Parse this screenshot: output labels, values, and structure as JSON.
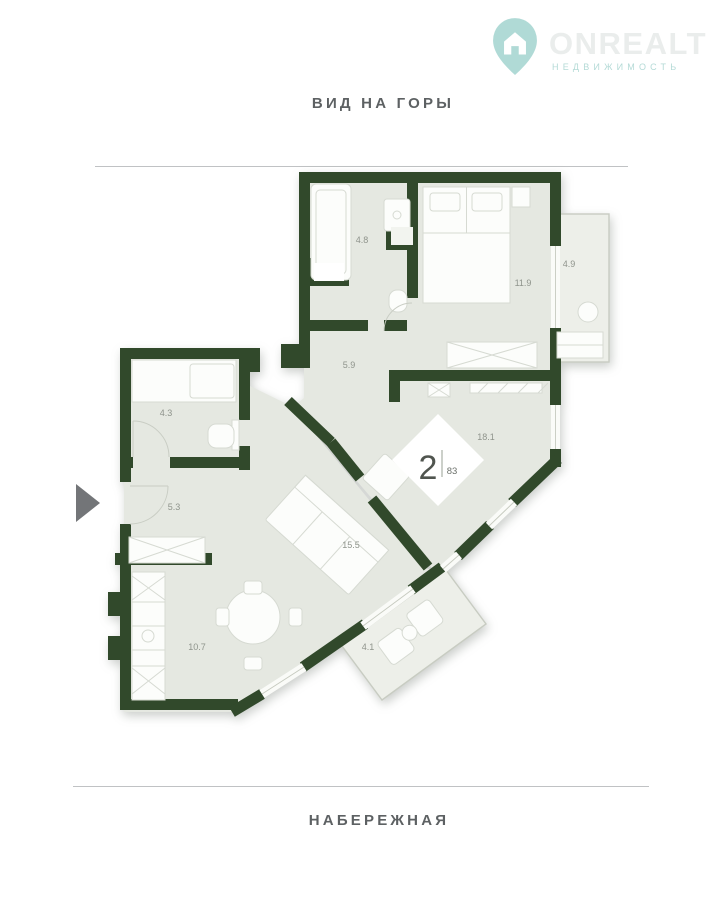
{
  "watermark": {
    "brand": "ONREALT",
    "tagline": "НЕДВИЖИМОСТЬ"
  },
  "orientation": {
    "top": "ВИД НА ГОРЫ",
    "bottom": "НАБЕРЕЖНАЯ"
  },
  "badge": {
    "rooms": "2",
    "area": "83"
  },
  "room_areas": {
    "bathroom_top": "4.8",
    "bedroom": "11.9",
    "balcony_right": "4.9",
    "hallway": "5.9",
    "bathroom_left": "4.3",
    "living": "18.1",
    "lounge": "15.5",
    "entry": "5.3",
    "kitchen": "10.7",
    "balcony_bottom": "4.1"
  },
  "colors": {
    "wall": "#31492b",
    "floor": "#e5e8e1",
    "balcony_floor": "#edefe9",
    "teal": "#55aea7",
    "label_gray": "#8f948c",
    "title_gray": "#5d6163",
    "arrow_gray": "#737578"
  }
}
